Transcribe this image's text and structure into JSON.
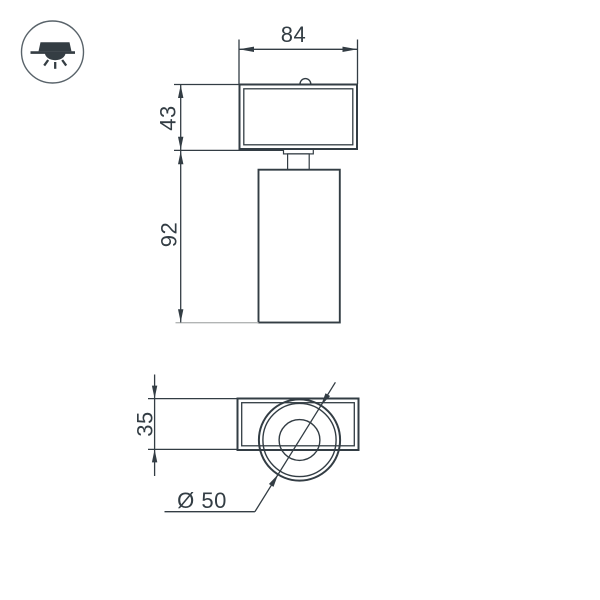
{
  "page": {
    "background": "#ffffff"
  },
  "legend_icon": {
    "name": "recessed-downlight-icon"
  },
  "drawing": {
    "type": "technical-dimension-drawing",
    "views": {
      "front": {
        "dimensions": {
          "width": "84",
          "head_height": "43",
          "body_height": "92"
        }
      },
      "bottom": {
        "dimensions": {
          "depth": "35",
          "diameter": "Ø 50"
        }
      }
    },
    "colors": {
      "line": "#333d44",
      "extension_gray": "#b2b5b5",
      "icon": "#343d43",
      "icon_ring": "#59636a",
      "background": "#ffffff"
    }
  }
}
